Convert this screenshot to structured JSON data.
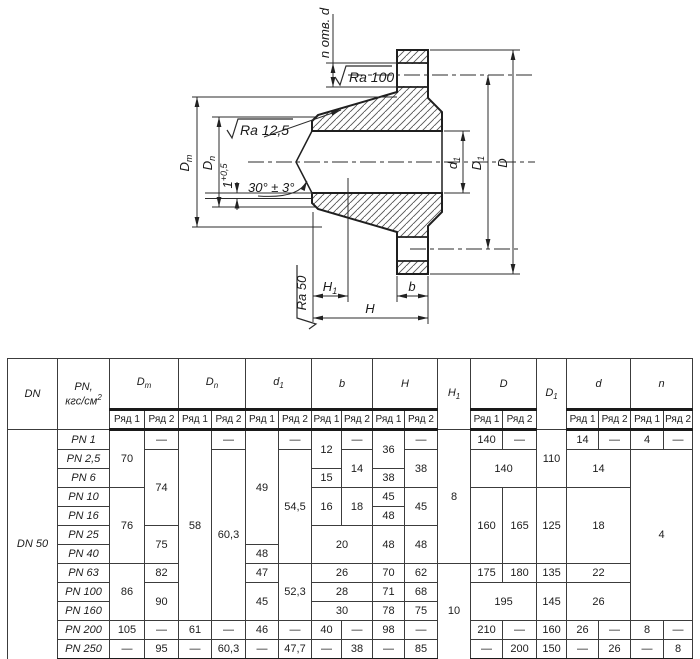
{
  "drawing": {
    "labels": {
      "n_holes": "n отв. d",
      "ra100": "Ra 100",
      "ra125": "Ra 12,5",
      "ra50": "Ra 50",
      "angle": "30° ± 3°",
      "land_base": "1",
      "land_sup": "+0,5",
      "dm_base": "D",
      "dm_sub": "m",
      "dn_base": "D",
      "dn_sub": "n",
      "d1_base": "d",
      "d1_sub": "1",
      "dd1_base": "D",
      "dd1_sub": "1",
      "d_big": "D",
      "h1_base": "H",
      "h1_sub": "1",
      "h": "H",
      "b": "b"
    },
    "line_color": "#2b2b2b"
  },
  "table": {
    "header": {
      "dn": "DN",
      "pn_line1": "PN,",
      "pn_line2_base": "кгс/см",
      "pn_line2_sup": "2",
      "row1": "Ряд 1",
      "row2": "Ряд 2",
      "groups": [
        {
          "base": "D",
          "sub": "m",
          "cols": 2
        },
        {
          "base": "D",
          "sub": "n",
          "cols": 2
        },
        {
          "base": "d",
          "sub": "1",
          "cols": 2
        },
        {
          "base": "b",
          "sub": "",
          "cols": 2
        },
        {
          "base": "H",
          "sub": "",
          "cols": 2
        },
        {
          "base": "H",
          "sub": "1",
          "cols": 1
        },
        {
          "base": "D",
          "sub": "",
          "cols": 2
        },
        {
          "base": "D",
          "sub": "1",
          "cols": 1
        },
        {
          "base": "d",
          "sub": "",
          "cols": 2
        },
        {
          "base": "n",
          "sub": "",
          "cols": 2
        }
      ]
    },
    "dn_value": "DN 50",
    "rows": [
      {
        "pn": "PN 1",
        "cells": [
          {
            "v": "70",
            "rs": 3
          },
          {
            "v": "—"
          },
          {
            "v": "58",
            "rs": 10
          },
          {
            "v": "—"
          },
          {
            "v": "49",
            "rs": 6
          },
          {
            "v": "—"
          },
          {
            "v": "12",
            "rs": 2
          },
          {
            "v": "—"
          },
          {
            "v": "36",
            "rs": 2
          },
          {
            "v": "—"
          },
          {
            "v": "8",
            "rs": 7
          },
          {
            "v": "140"
          },
          {
            "v": "—"
          },
          {
            "v": "110",
            "rs": 3
          },
          {
            "v": "14"
          },
          {
            "v": "—"
          },
          {
            "v": "4"
          },
          {
            "v": "—"
          }
        ]
      },
      {
        "pn": "PN 2,5",
        "cells": [
          {
            "v": "74",
            "rs": 4
          },
          {
            "v": "60,3",
            "rs": 9
          },
          {
            "v": "54,5",
            "rs": 6
          },
          {
            "v": "14",
            "rs": 2
          },
          {
            "v": "38",
            "rs": 2
          },
          {
            "v": "140",
            "cs": 2,
            "rs": 2
          },
          {
            "v": "14",
            "cs": 2,
            "rs": 2
          },
          {
            "v": "4",
            "cs": 2,
            "rs": 9
          }
        ]
      },
      {
        "pn": "PN 6",
        "cells": [
          {
            "v": "15"
          },
          {
            "v": "38"
          }
        ]
      },
      {
        "pn": "PN 10",
        "cells": [
          {
            "v": "76",
            "rs": 4
          },
          {
            "v": "16",
            "rs": 2
          },
          {
            "v": "18",
            "rs": 2
          },
          {
            "v": "45"
          },
          {
            "v": "45",
            "rs": 2
          },
          {
            "v": "160",
            "rs": 4
          },
          {
            "v": "165",
            "rs": 4
          },
          {
            "v": "125",
            "rs": 4
          },
          {
            "v": "18",
            "cs": 2,
            "rs": 4
          }
        ]
      },
      {
        "pn": "PN 16",
        "cells": [
          {
            "v": "48"
          }
        ]
      },
      {
        "pn": "PN 25",
        "cells": [
          {
            "v": "75",
            "rs": 2
          },
          {
            "v": "20",
            "cs": 2,
            "rs": 2
          },
          {
            "v": "48",
            "rs": 2
          },
          {
            "v": "48",
            "rs": 2
          }
        ]
      },
      {
        "pn": "PN 40",
        "cells": [
          {
            "v": "48"
          }
        ]
      },
      {
        "pn": "PN 63",
        "cells": [
          {
            "v": "86",
            "rs": 3
          },
          {
            "v": "82"
          },
          {
            "v": "47"
          },
          {
            "v": "52,3",
            "rs": 3
          },
          {
            "v": "26",
            "cs": 2
          },
          {
            "v": "70"
          },
          {
            "v": "62"
          },
          {
            "v": "10",
            "rs": 5
          },
          {
            "v": "175"
          },
          {
            "v": "180"
          },
          {
            "v": "135"
          },
          {
            "v": "22",
            "cs": 2
          }
        ]
      },
      {
        "pn": "PN 100",
        "cells": [
          {
            "v": "90",
            "rs": 2
          },
          {
            "v": "45",
            "rs": 2
          },
          {
            "v": "28",
            "cs": 2
          },
          {
            "v": "71"
          },
          {
            "v": "68"
          },
          {
            "v": "195",
            "cs": 2,
            "rs": 2
          },
          {
            "v": "145",
            "rs": 2
          },
          {
            "v": "26",
            "cs": 2,
            "rs": 2
          }
        ]
      },
      {
        "pn": "PN 160",
        "cells": [
          {
            "v": "30",
            "cs": 2
          },
          {
            "v": "78"
          },
          {
            "v": "75"
          }
        ]
      },
      {
        "pn": "PN 200",
        "cells": [
          {
            "v": "105"
          },
          {
            "v": "—"
          },
          {
            "v": "61"
          },
          {
            "v": "—"
          },
          {
            "v": "46"
          },
          {
            "v": "—"
          },
          {
            "v": "40"
          },
          {
            "v": "—"
          },
          {
            "v": "98"
          },
          {
            "v": "—"
          },
          {
            "v": "210"
          },
          {
            "v": "—"
          },
          {
            "v": "160"
          },
          {
            "v": "26"
          },
          {
            "v": "—"
          },
          {
            "v": "8"
          },
          {
            "v": "—"
          }
        ]
      },
      {
        "pn": "PN 250",
        "cells": [
          {
            "v": "—"
          },
          {
            "v": "95"
          },
          {
            "v": "—"
          },
          {
            "v": "60,3"
          },
          {
            "v": "—"
          },
          {
            "v": "47,7"
          },
          {
            "v": "—"
          },
          {
            "v": "38"
          },
          {
            "v": "—"
          },
          {
            "v": "85"
          },
          {
            "v": "—"
          },
          {
            "v": "200"
          },
          {
            "v": "150"
          },
          {
            "v": "—"
          },
          {
            "v": "26"
          },
          {
            "v": "—"
          },
          {
            "v": "8"
          }
        ]
      }
    ]
  }
}
